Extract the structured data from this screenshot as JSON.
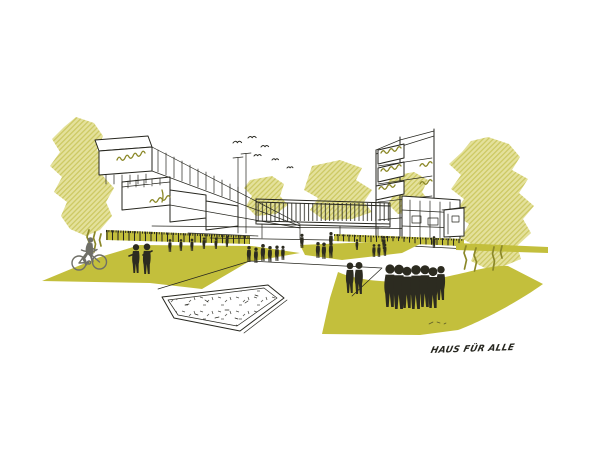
{
  "scene": {
    "type": "architectural-concept-sketch",
    "caption": "HAUS FÜR ALLE",
    "colors": {
      "paper": "#ffffff",
      "ink": "#26261f",
      "lawn": "#c3bf3c",
      "tree_base": "#e4e19b",
      "tree_line": "#cdc964",
      "planter": "#8b8828",
      "figure": "#2c2b20",
      "cyclist": "#6f6f67"
    },
    "counts": {
      "birds": 6,
      "pedestrians": 34,
      "cyclists": 1
    },
    "elements": [
      "left-tree",
      "left-terraced-building",
      "central-pavilion",
      "right-building",
      "right-tree",
      "background-trees",
      "lawn-wedges",
      "sandpit-sketch",
      "pedestrians",
      "cyclist",
      "birds",
      "caption"
    ]
  }
}
